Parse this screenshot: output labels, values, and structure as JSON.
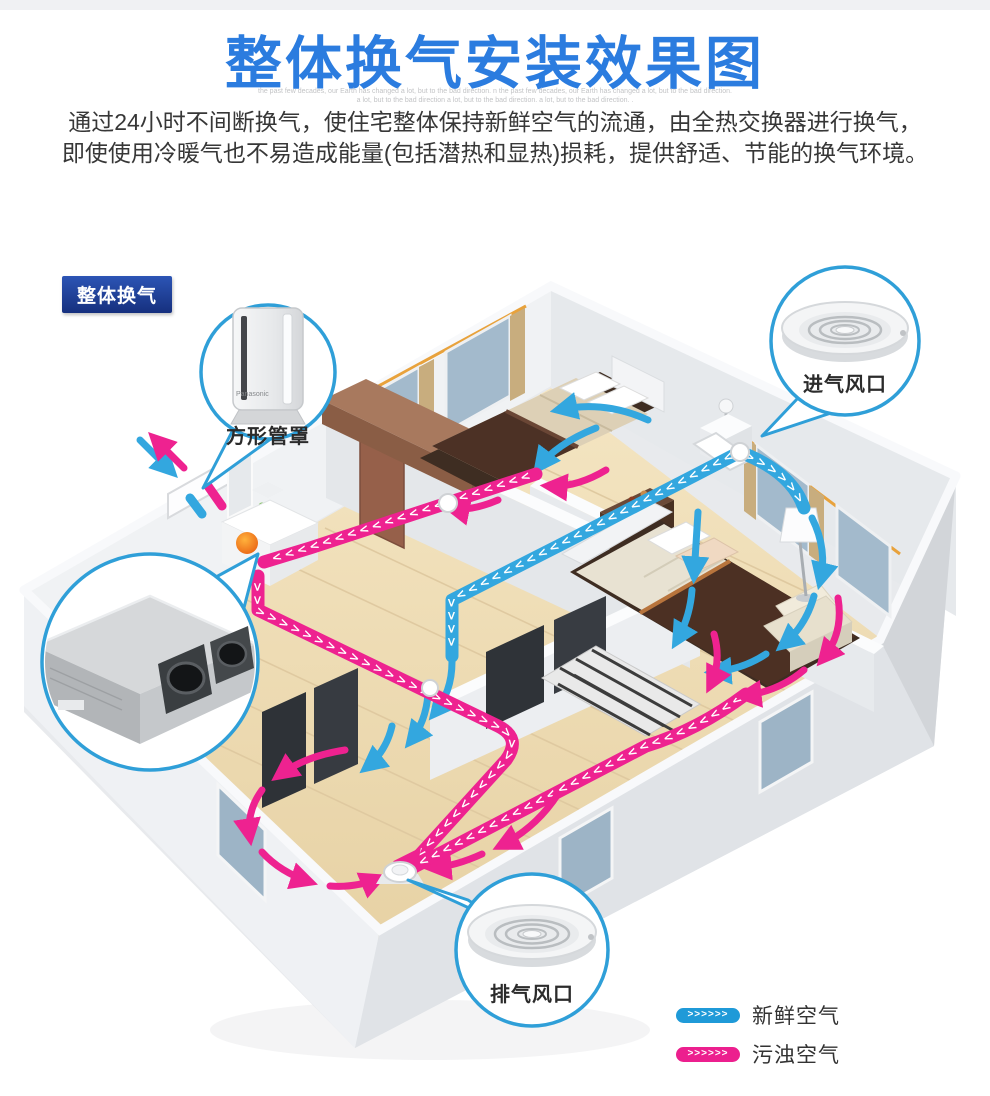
{
  "header": {
    "title": "整体换气安装效果图",
    "micro_text_line1": "the past few decades, our Earth has changed a lot, but to the bad direction. n the past few decades, our Earth has changed a lot, but to the bad direction.",
    "micro_text_line2": "a lot, but to the bad direction a lot, but to the bad direction. a lot, but to the bad direction. .",
    "description_line1": "通过24小时不间断换气，使住宅整体保持新鲜空气的流通，由全热交换器进行换气，",
    "description_line2": "即使使用冷暖气也不易造成能量(包括潜热和显热)损耗，提供舒适、节能的换气环境。"
  },
  "diagram": {
    "section_tag": "整体换气",
    "callout_square_duct_cover": "方形管罩",
    "callout_square_duct_brand": "Panasonic",
    "callout_intake_vent": "进气风口",
    "callout_exhaust_vent": "排气风口",
    "duct_chevron_char": ">"
  },
  "legend": {
    "fresh_air": {
      "label": "新鲜空气",
      "arrows": ">>>>>>",
      "color": "#1f9ad8"
    },
    "polluted_air": {
      "label": "污浊空气",
      "arrows": ">>>>>>",
      "color": "#ec1f8e"
    }
  },
  "colors": {
    "title_blue": "#2b7cdf",
    "fresh_air_blue": "#33a7df",
    "polluted_air_pink": "#ee2290",
    "tag_navy": "#16307e",
    "callout_border_blue": "#2f9fd8"
  }
}
